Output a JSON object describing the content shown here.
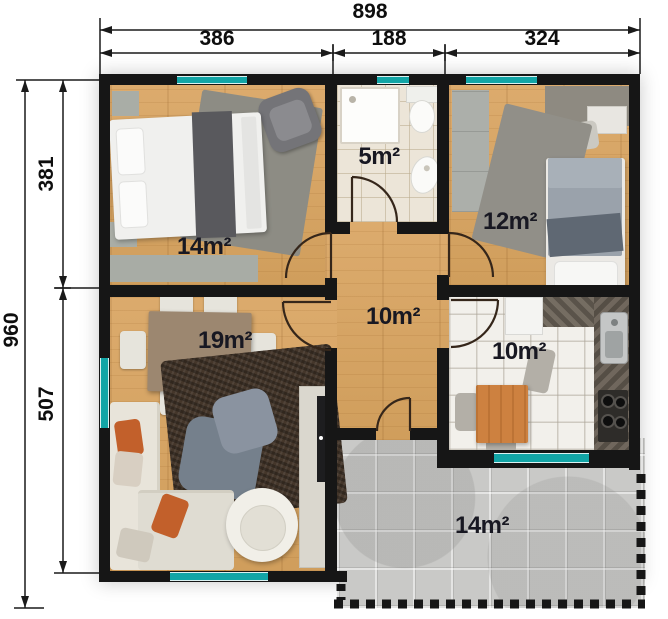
{
  "plan": {
    "title": "house-floor-plan",
    "dimensions": {
      "top_total": "898",
      "top_segments": [
        "386",
        "188",
        "324"
      ],
      "left_total": "960",
      "left_segments": [
        "381",
        "507"
      ]
    },
    "rooms": [
      {
        "name": "bedroom-1",
        "area": "14m²"
      },
      {
        "name": "bathroom",
        "area": "5m²"
      },
      {
        "name": "bedroom-2",
        "area": "12m²"
      },
      {
        "name": "hallway",
        "area": "10m²"
      },
      {
        "name": "living-room",
        "area": "19m²"
      },
      {
        "name": "kitchen",
        "area": "10m²"
      },
      {
        "name": "terrace",
        "area": "14m²"
      }
    ],
    "colors": {
      "wall": "#161616",
      "window_accent": "#12a5a6",
      "wood_floor": "#d8a667",
      "bath_tile": "#ece5d8",
      "kitchen_tile": "#f2f0eb",
      "terrace_paver": "#c9c9c7",
      "label_text": "#181822"
    }
  }
}
